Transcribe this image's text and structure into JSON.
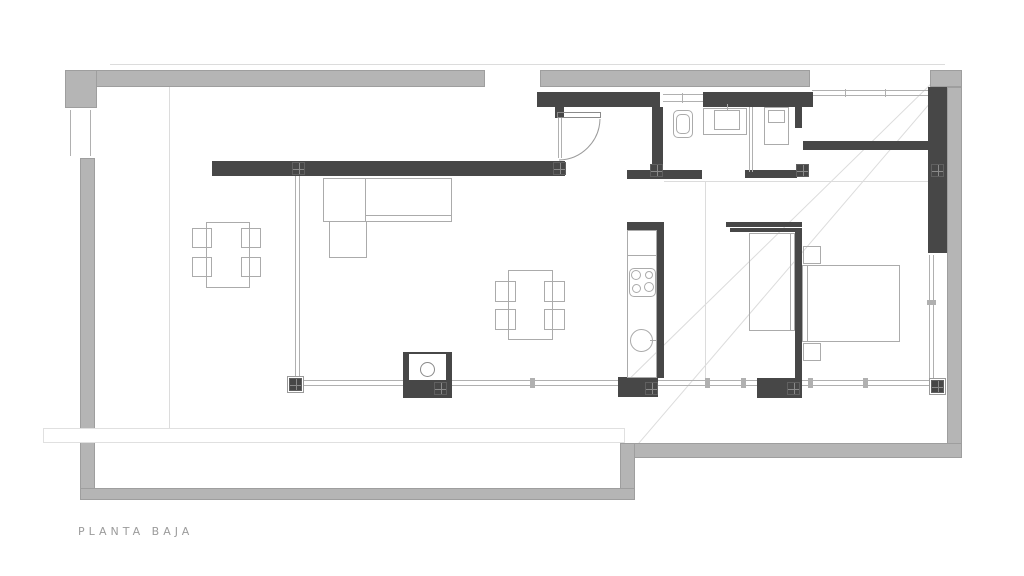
{
  "title": {
    "label": "PLANTA BAJA"
  },
  "colors": {
    "boundary_wall": "#b5b5b5",
    "boundary_edge": "#9e9e9e",
    "interior_wall": "#474747",
    "furniture_line": "#ababab",
    "glazing_line": "#b0b0b0",
    "faint_line": "#dcdcdc",
    "label_text": "#9b9b9b",
    "background": "#ffffff"
  }
}
